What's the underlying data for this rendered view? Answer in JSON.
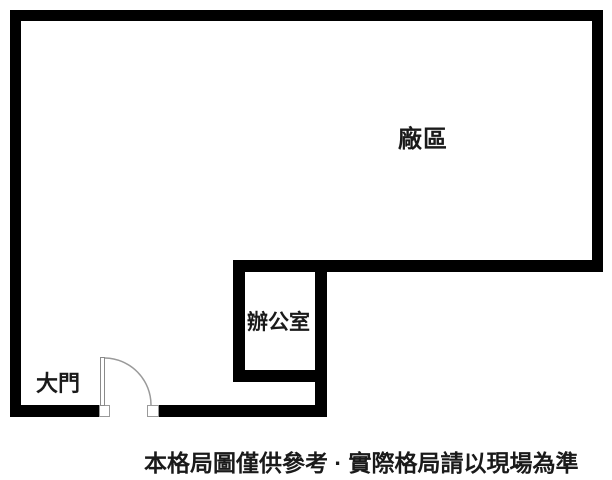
{
  "floorplan": {
    "areas": {
      "factory_label": "廠區",
      "office_label": "辦公室",
      "main_door_label": "大門"
    },
    "caption": "本格局圖僅供參考 · 實際格局請以現場為準",
    "colors": {
      "background": "#ffffff",
      "wall": "#000000",
      "text": "#1a1a1a",
      "door_swing": "#9a9a9a",
      "door_leaf_border": "#8a8a8a"
    }
  }
}
